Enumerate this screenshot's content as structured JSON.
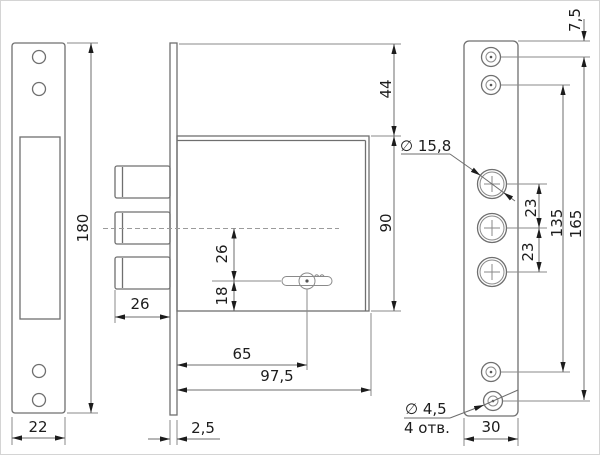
{
  "colors": {
    "background": "#ffffff",
    "outline": "#6f6f6f",
    "dimension_line": "#6d6d6d",
    "text": "#1c1c1c",
    "centerline": "#9b9b9b"
  },
  "left_view": {
    "height": "180",
    "width": "22"
  },
  "middle_view": {
    "top_to_case": "44",
    "case_height": "90",
    "bolt_length": "26",
    "axis_to_keyhole": "26",
    "keyhole_to_bottom": "18",
    "keyhole_offset": "65",
    "case_depth": "97,5",
    "faceplate_thickness": "2,5"
  },
  "right_view": {
    "edge_to_first_hole": "7,5",
    "cylinder_hole_diameter": "∅ 15,8",
    "hole_pitch_upper": "23",
    "hole_pitch_lower": "23",
    "inner_span": "135",
    "outer_span": "165",
    "screw_hole_diameter": "∅ 4,5",
    "screw_hole_count": "4 отв.",
    "plate_width": "30"
  }
}
